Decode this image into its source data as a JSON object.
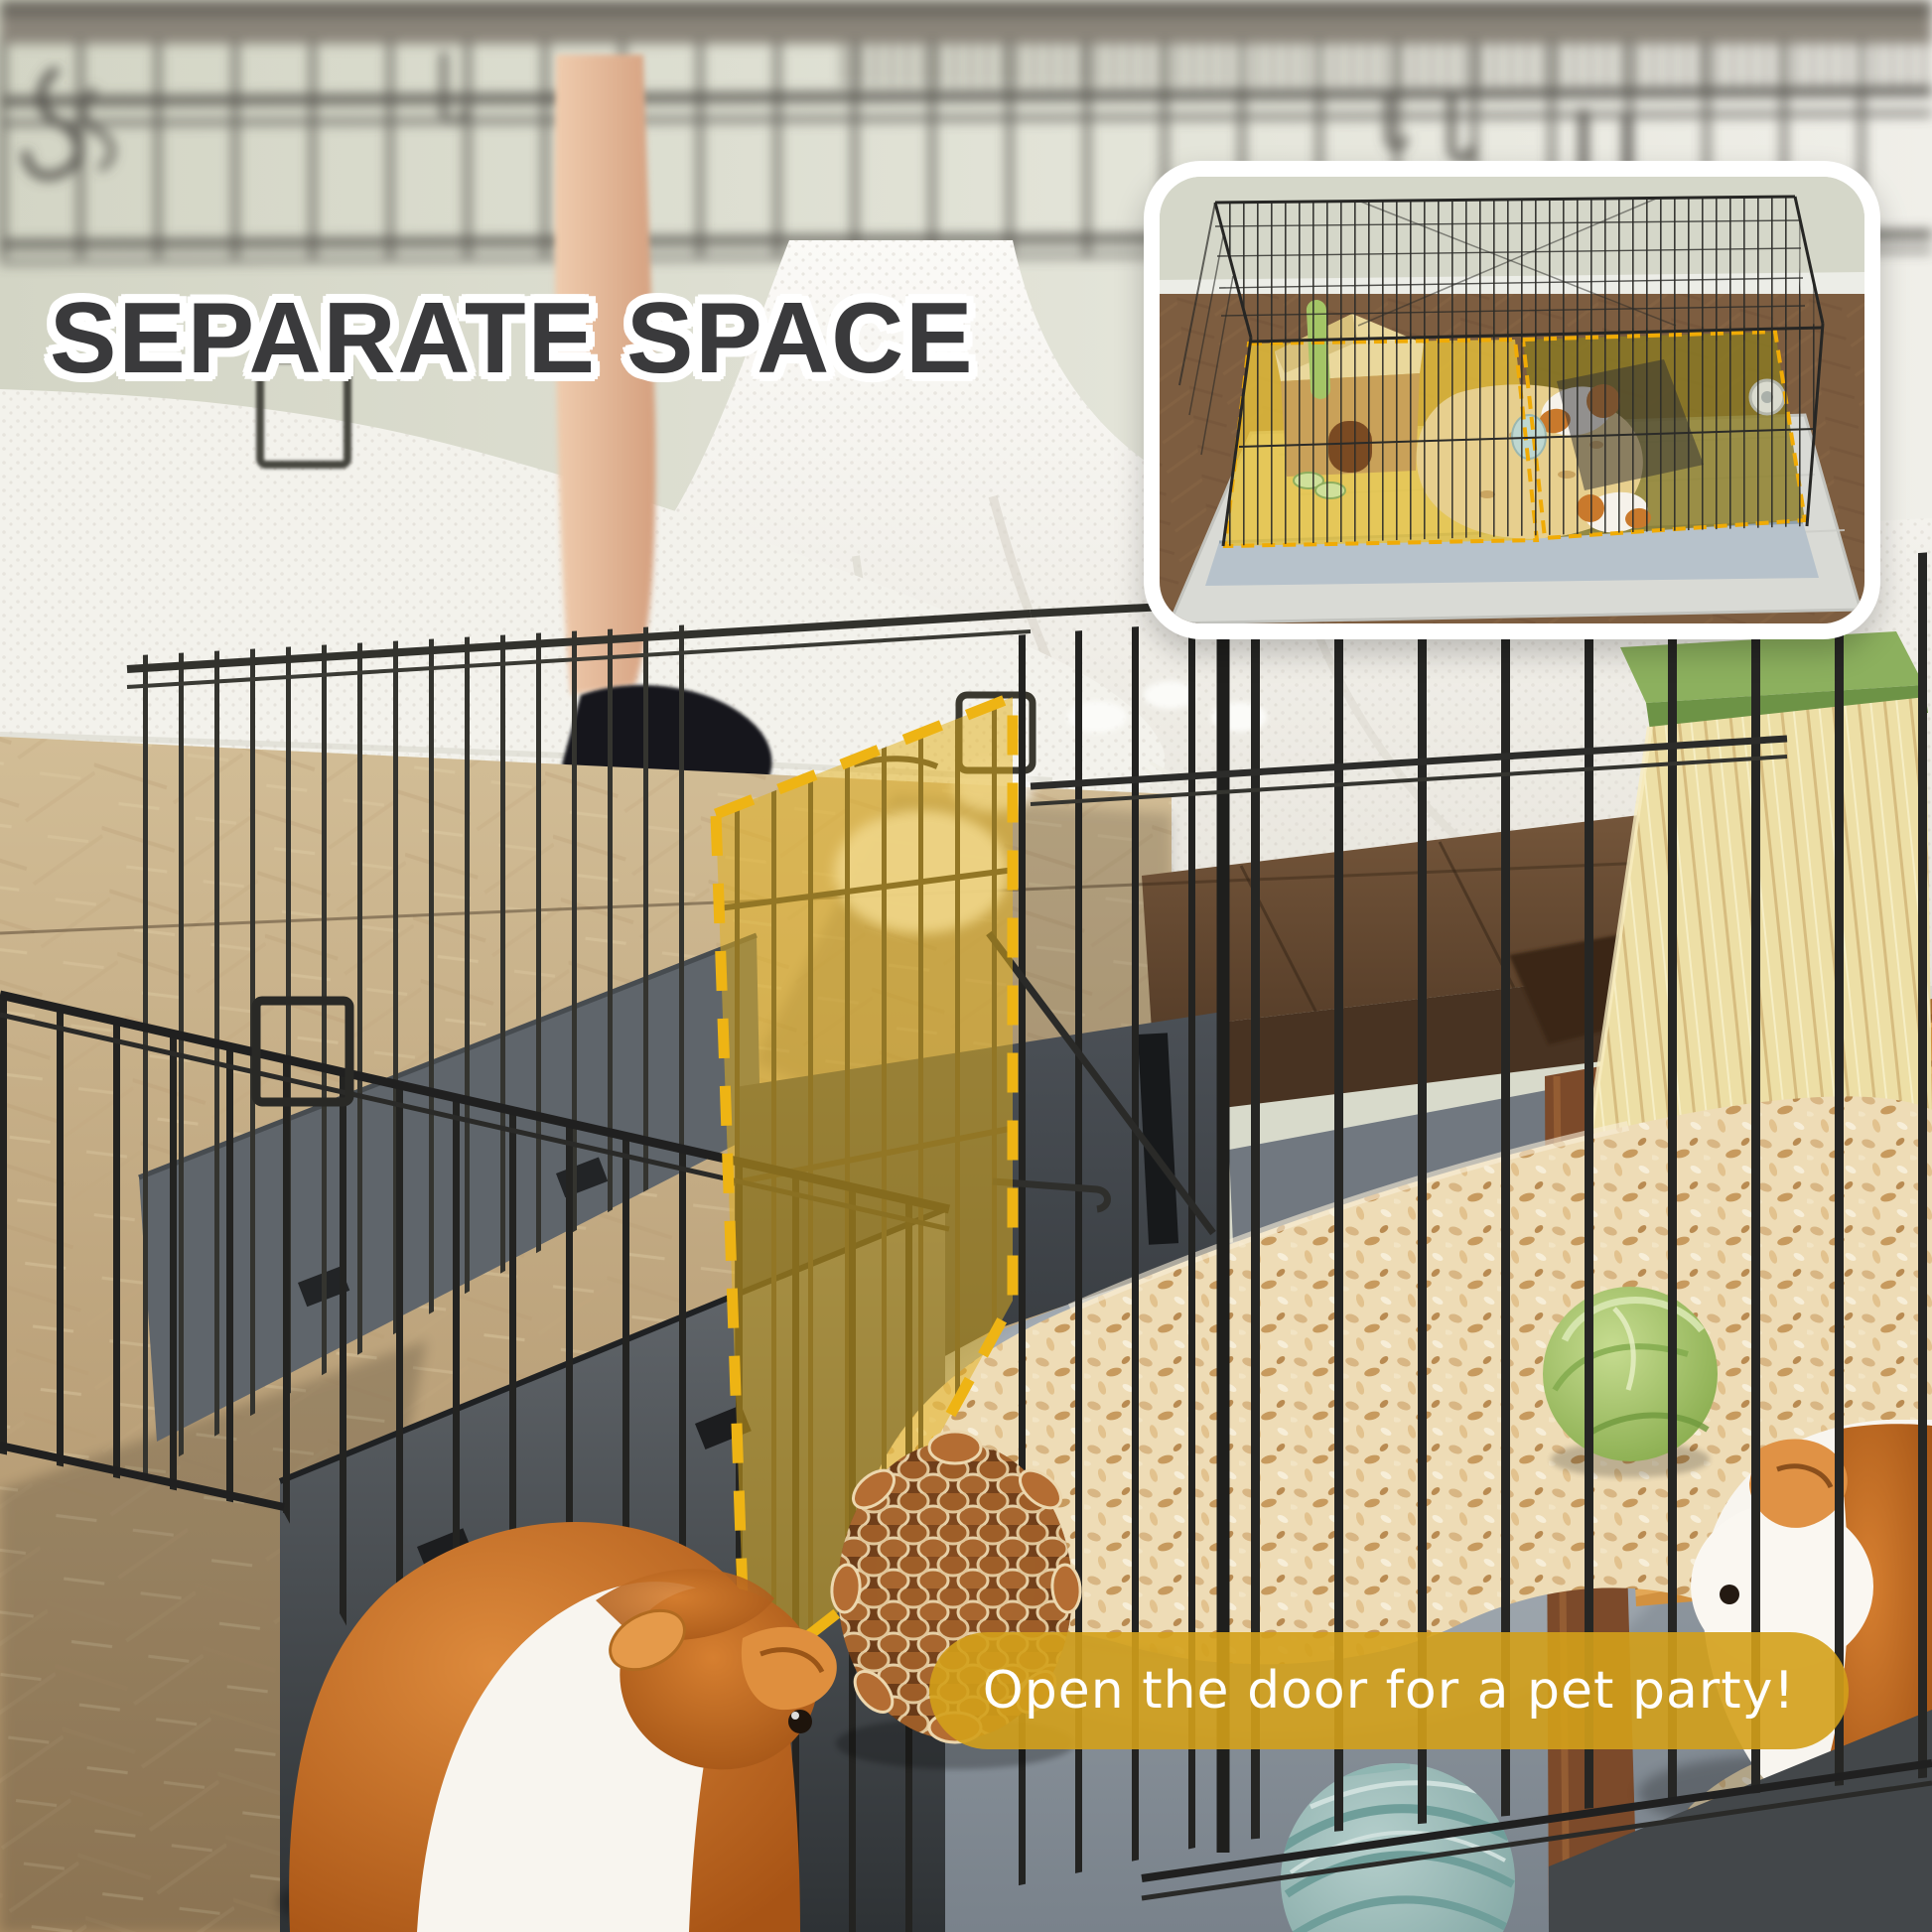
{
  "headline": {
    "text": "SEPARATE SPACE",
    "color": "#3a3a3c",
    "outline_color": "#ffffff"
  },
  "caption": {
    "text": "Open the door for a pet party!",
    "text_color": "#ffffff",
    "pill_color": "#d3a01f"
  },
  "door_highlight": {
    "fill": "#e2b01c",
    "dash_color": "#eeb414"
  },
  "inset": {
    "border_color": "#ffffff",
    "zone_left_fill": "#e7c23a",
    "zone_right_fill": "#8a7a22",
    "dash_color": "#f0ab06"
  }
}
